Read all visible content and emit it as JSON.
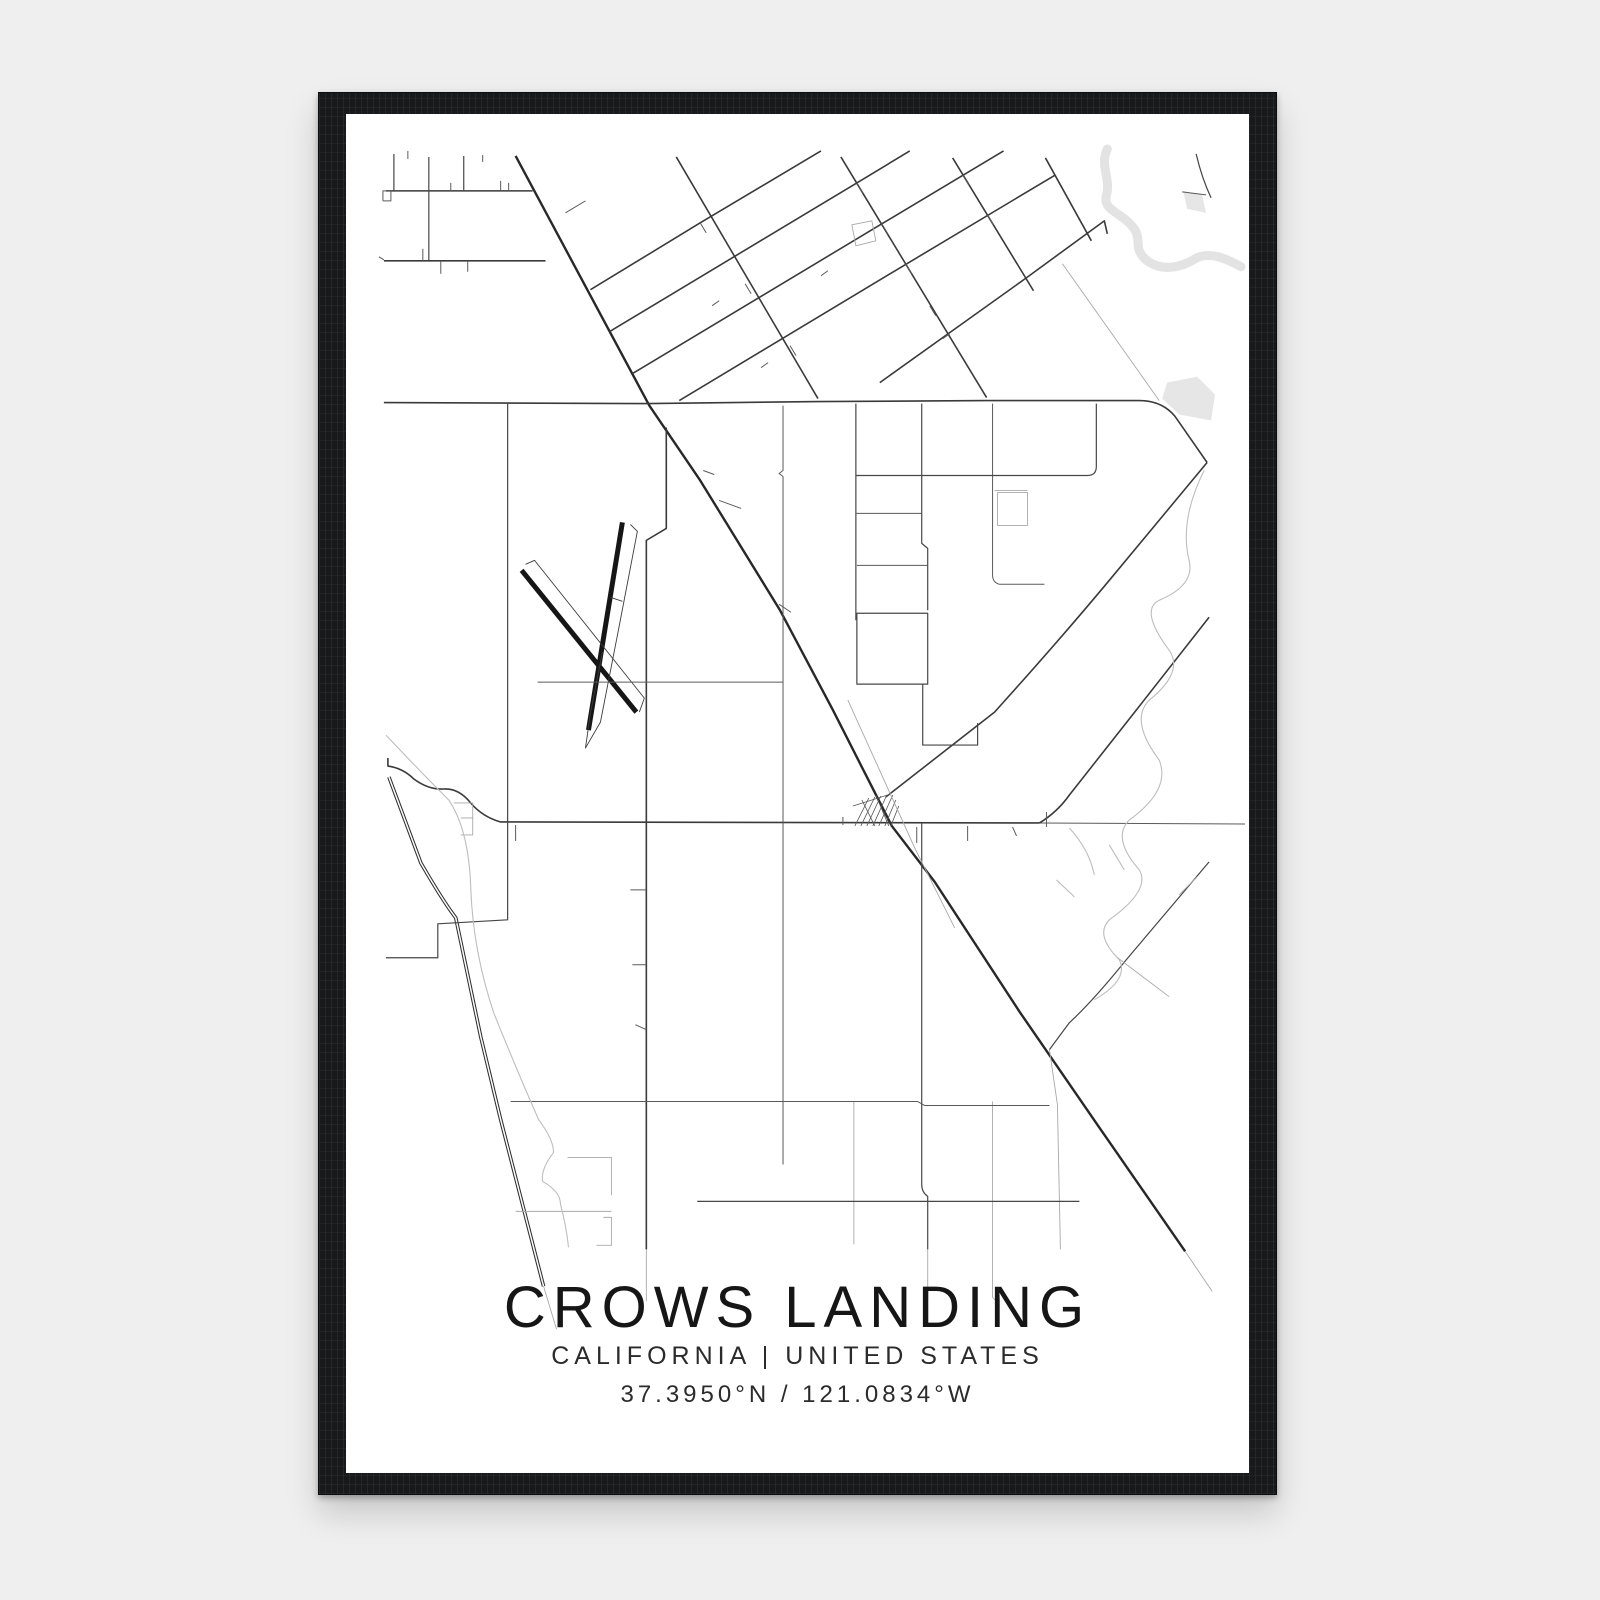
{
  "poster": {
    "title": "CROWS LANDING",
    "subtitle": "CALIFORNIA | UNITED STATES",
    "coordinates": "37.3950°N / 121.0834°W"
  },
  "theme": {
    "page-bg": "#efefef",
    "frame-color": "#17191b",
    "paper-color": "#ffffff",
    "ink": "#1e1e1e"
  },
  "map": {
    "view": "345 113 905 1361",
    "road_color": "#3a3a3a",
    "highway_color": "#282828",
    "water_color": "#e3e3e3",
    "fills": [
      {
        "n": "river-pond",
        "pts": "1168,382 1198,376 1216,394 1212,420 1180,414 1163,398"
      },
      {
        "n": "river-pond-small",
        "pts": "1184,190 1203,194 1207,212 1188,208"
      }
    ],
    "paths": [
      {
        "n": "river",
        "c": "water",
        "d": "M1108,148 C1100,165 1112,178 1107,195 C1103,210 1124,212 1135,228 C1143,240 1133,248 1148,260 C1162,270 1180,268 1196,258 C1210,250 1228,258 1242,266"
      },
      {
        "n": "highway",
        "c": "hwy",
        "d": "M515,155 L649,405 L700,480 L780,610 L833,710 L892,826 L935,882 L1020,1012 L1100,1128 L1186,1252"
      },
      {
        "n": "highway-fade",
        "c": "faint",
        "d": "M1186,1252 L1213,1292"
      },
      {
        "n": "canal",
        "c": "canal",
        "double": true,
        "d": "M388,777 L420,863 Q442,901 455,918 L480,1037 Q490,1078 500,1120 L543,1287"
      },
      {
        "n": "canal-fade",
        "c": "faint",
        "d": "M543,1287 L556,1330"
      },
      {
        "n": "runway-1",
        "c": "runway",
        "d": "M622,522 L588,730"
      },
      {
        "n": "runway-2",
        "c": "runway",
        "d": "M521,570 L636,712"
      },
      {
        "n": "runway-taxiway",
        "c": "rthin",
        "d": "M630,524 L637,531 L618,630 L600,722 L585,748 L590,713 L602,652"
      },
      {
        "n": "runway-taxiway",
        "c": "rthin",
        "d": "M525,564 L534,560 L644,698 L639,712"
      },
      {
        "n": "runway-taxiway",
        "c": "rthin",
        "d": "M610,597 L622,601"
      },
      {
        "n": "road-main-upper",
        "c": "med",
        "d": "M383,402 L648,403 L818,401 L987,400 L1140,400 Q1163,400 1176,416 L1208,462"
      },
      {
        "n": "road-northeast-1",
        "c": "med",
        "d": "M1208,462 L1110,580 Q1060,640 995,712 L886,797"
      },
      {
        "n": "road-main-town",
        "c": "med",
        "d": "M387,758 L387,766 Q402,768 413,779 Q428,790 443,789 Q458,788 470,803 Q482,817 500,822 L1040,823"
      },
      {
        "n": "road-main-town-east",
        "c": "thin",
        "d": "M1040,823 L1246,824"
      },
      {
        "n": "road-northeast-2",
        "c": "med",
        "d": "M1040,823 Q1058,812 1070,795 L1137,710 L1210,617"
      },
      {
        "n": "road-northeast-3",
        "c": "medthin",
        "d": "M1210,862 L1127,960 Q1093,1002 1070,1023 L1050,1050"
      },
      {
        "n": "road-northeast-3-south",
        "c": "faint",
        "d": "M1050,1050 L1058,1105 L1061,1250"
      },
      {
        "n": "road-spur",
        "c": "faint",
        "d": "M1117,957 L1170,997"
      },
      {
        "n": "road-spur",
        "c": "faint",
        "d": "M1180,895 L1198,877"
      },
      {
        "n": "grid-nw-h1",
        "c": "med",
        "d": "M385,190 L532,190"
      },
      {
        "n": "grid-nw-h2",
        "c": "med",
        "d": "M383,260 L545,260"
      },
      {
        "n": "grid-nw-v1",
        "c": "medthin",
        "d": "M393,153 L393,190"
      },
      {
        "n": "grid-nw-v2",
        "c": "medthin",
        "d": "M428,156 L428,260"
      },
      {
        "n": "grid-nw-v3",
        "c": "medthin",
        "d": "M463,155 L463,190"
      },
      {
        "n": "grid-nw-stub",
        "c": "thin",
        "d": "M407,150 L407,158"
      },
      {
        "n": "grid-nw-stub",
        "c": "thin",
        "d": "M440,260 L440,273"
      },
      {
        "n": "grid-nw-stub",
        "c": "thin",
        "d": "M467,260 L467,271"
      },
      {
        "n": "grid-nw-stub",
        "c": "thin",
        "d": "M500,180 L500,190"
      },
      {
        "n": "grid-nw-stub",
        "c": "thin",
        "d": "M482,154 L482,161"
      },
      {
        "n": "grid-nw-stub",
        "c": "thin",
        "d": "M508,182 L508,190"
      },
      {
        "n": "grid-nw-stub",
        "c": "thin",
        "d": "M422,248 L422,260"
      },
      {
        "n": "grid-nw-stub",
        "c": "thin",
        "d": "M450,182 L450,190"
      },
      {
        "n": "grid-nw-stub",
        "c": "thin",
        "d": "M378,256 L383,259"
      },
      {
        "n": "grid-nw-square",
        "c": "thin",
        "d": "M382,200 L382,190 L390,190 L390,200 L382,200"
      },
      {
        "n": "highway-spur",
        "c": "thin",
        "d": "M565,212 L585,200"
      },
      {
        "n": "grid-ne-q1",
        "c": "med",
        "d": "M676,156 L818,398"
      },
      {
        "n": "grid-ne-q2",
        "c": "med",
        "d": "M841,156 L987,397"
      },
      {
        "n": "grid-ne-q3",
        "c": "med",
        "d": "M953,157 L1034,290"
      },
      {
        "n": "grid-ne-q4",
        "c": "med",
        "d": "M1046,157 L1092,240"
      },
      {
        "n": "grid-ne-p1",
        "c": "med",
        "d": "M590,289 L700,222 L821,150"
      },
      {
        "n": "grid-ne-p2",
        "c": "med",
        "d": "M609,331 L857,182 L910,150"
      },
      {
        "n": "grid-ne-p3",
        "c": "med",
        "d": "M632,373 L882,223 L1004,150"
      },
      {
        "n": "grid-ne-p4",
        "c": "med",
        "d": "M679,400 L907,263 L1056,174"
      },
      {
        "n": "grid-ne-p5",
        "c": "med",
        "d": "M880,382 L1027,277 L1105,220 L1108,233"
      },
      {
        "n": "grid-ne-faint-street",
        "c": "faint",
        "d": "M1063,263 L1160,400"
      },
      {
        "n": "grid-ne-building",
        "c": "faint",
        "d": "M852,224 L872,220 L876,240 L856,245 Z"
      },
      {
        "n": "grid-ne-tick",
        "c": "thin",
        "d": "M700,222 L706,232"
      },
      {
        "n": "grid-ne-tick",
        "c": "thin",
        "d": "M745,283 L751,293"
      },
      {
        "n": "grid-ne-tick",
        "c": "thin",
        "d": "M790,345 L796,355"
      },
      {
        "n": "grid-ne-tick",
        "c": "thin",
        "d": "M857,182 L863,192"
      },
      {
        "n": "grid-ne-tick",
        "c": "thin",
        "d": "M882,223 L888,233"
      },
      {
        "n": "grid-ne-tick",
        "c": "thin",
        "d": "M906,263 L912,273"
      },
      {
        "n": "grid-ne-tick",
        "c": "thin",
        "d": "M930,305 L936,315"
      },
      {
        "n": "grid-ne-tick",
        "c": "thin",
        "d": "M963,174 L969,184"
      },
      {
        "n": "grid-ne-tick",
        "c": "thin",
        "d": "M988,214 L994,224"
      },
      {
        "n": "grid-ne-tick",
        "c": "thin",
        "d": "M719,300 L712,305"
      },
      {
        "n": "grid-ne-tick",
        "c": "thin",
        "d": "M768,362 L761,367"
      },
      {
        "n": "grid-ne-tick",
        "c": "thin",
        "d": "M828,270 L821,275"
      },
      {
        "n": "grid-ne-tick",
        "c": "thin",
        "d": "M950,333 L943,338"
      },
      {
        "n": "highway-spur",
        "c": "thin",
        "d": "M703,470 L714,474"
      },
      {
        "n": "highway-spur",
        "c": "thin",
        "d": "M719,500 L741,508"
      },
      {
        "n": "highway-spur",
        "c": "thin",
        "d": "M779,604 L791,612"
      },
      {
        "n": "road-vertical-center",
        "c": "med",
        "d": "M666,427 L666,528 L646,540 L646,1250"
      },
      {
        "n": "road-vertical-center-fade",
        "c": "faint",
        "d": "M646,1250 L646,1302"
      },
      {
        "n": "road-tick",
        "c": "thin",
        "d": "M630,890 L646,890"
      },
      {
        "n": "road-tick",
        "c": "thin",
        "d": "M632,965 L646,965"
      },
      {
        "n": "road-tick",
        "c": "thin",
        "d": "M635,1025 L646,1030"
      },
      {
        "n": "road-vertical-west",
        "c": "medthin",
        "d": "M507,403 L507,920 L437,924 L437,958 L385,958"
      },
      {
        "n": "road-horizontal-airfield",
        "c": "thin",
        "d": "M537,682 L783,682"
      },
      {
        "n": "road-vertical-783",
        "c": "thin",
        "d": "M783,405 L783,470 L779,473 L783,476 L783,1165"
      },
      {
        "n": "road-vertical-856",
        "c": "medthin",
        "d": "M856,403 L856,620"
      },
      {
        "n": "road-tick",
        "c": "thin",
        "d": "M856,513 L922,513"
      },
      {
        "n": "road-h-565",
        "c": "thin",
        "d": "M857,565 L928,565"
      },
      {
        "n": "road-block",
        "c": "medthin",
        "d": "M857,613 L928,613 L928,684 L857,684 Z"
      },
      {
        "n": "road-vertical-922",
        "c": "medthin",
        "d": "M922,403 L922,543 L928,548 L928,610"
      },
      {
        "n": "road-block",
        "c": "medthin",
        "d": "M923,684 L923,745 L978,745 L978,723"
      },
      {
        "n": "road-vertical-922-south",
        "c": "medthin",
        "d": "M922,823 L922,1185 Q922,1193 928,1197 L928,1250"
      },
      {
        "n": "road-vertical-922-fade",
        "c": "faint",
        "d": "M928,1250 L928,1300"
      },
      {
        "n": "road-vertical-993",
        "c": "thin",
        "d": "M993,403 L993,575 Q993,582 1000,584 L1045,584"
      },
      {
        "n": "road-corner-block",
        "c": "medthin",
        "d": "M856,475 L1088,475 Q1097,475 1097,466 L1097,403"
      },
      {
        "n": "road-h-490",
        "c": "faint",
        "d": "M995,490 L1028,490"
      },
      {
        "n": "field-square",
        "c": "faint",
        "d": "M998,492 L1028,492 L1028,525 L998,525 Z"
      },
      {
        "n": "road-vertical-854-south",
        "c": "faint",
        "d": "M854,1102 L854,1245"
      },
      {
        "n": "road-vertical-993-south",
        "c": "faint",
        "d": "M993,1102 L993,1298 L1000,1306"
      },
      {
        "n": "road-horizontal-1102",
        "c": "thin",
        "d": "M510,1102 L918,1102 L925,1106 L1050,1106"
      },
      {
        "n": "road-horizontal-1202",
        "c": "medthin",
        "d": "M697,1202 L1080,1202"
      },
      {
        "n": "grid-sw-faint",
        "c": "faint",
        "d": "M567,1158 L611,1158 L611,1196"
      },
      {
        "n": "grid-sw-faint",
        "c": "faint",
        "d": "M515,1212 L611,1212"
      },
      {
        "n": "grid-sw-faint",
        "c": "faint",
        "d": "M603,1218 L611,1218 L611,1246 L596,1246"
      },
      {
        "n": "road-step",
        "c": "faint",
        "d": "M453,803 L472,803 L472,835 L460,835"
      },
      {
        "n": "road-step-tick",
        "c": "faint",
        "d": "M460,818 L472,818"
      },
      {
        "n": "road-stub",
        "c": "thin",
        "d": "M515,825 L515,841"
      },
      {
        "n": "town-grid-edge",
        "c": "hatch",
        "d": "M853,806 L891,794"
      },
      {
        "n": "town-grid-street",
        "c": "hatch",
        "d": "M855,826 L869,798"
      },
      {
        "n": "town-grid-street",
        "c": "hatch",
        "d": "M861,826 L875,797"
      },
      {
        "n": "town-grid-street",
        "c": "hatch",
        "d": "M867,826 L881,796"
      },
      {
        "n": "town-grid-street",
        "c": "hatch",
        "d": "M873,826 L887,795"
      },
      {
        "n": "town-grid-street",
        "c": "hatch",
        "d": "M879,826 L893,795"
      },
      {
        "n": "town-grid-street",
        "c": "hatch",
        "d": "M885,826 L896,800"
      },
      {
        "n": "town-grid-street",
        "c": "hatch",
        "d": "M891,826 L899,806"
      },
      {
        "n": "town-grid-cross",
        "c": "hatch",
        "d": "M862,800 L875,826"
      },
      {
        "n": "town-grid-cross",
        "c": "hatch",
        "d": "M876,795 L889,826"
      },
      {
        "n": "town-stub",
        "c": "thin",
        "d": "M917,827 L917,843"
      },
      {
        "n": "town-stub",
        "c": "thin",
        "d": "M968,826 L968,841"
      },
      {
        "n": "town-stub",
        "c": "thin",
        "d": "M1013,827 L1017,836"
      },
      {
        "n": "town-stub",
        "c": "thin",
        "d": "M1047,812 L1047,827"
      },
      {
        "n": "town-stub",
        "c": "thin",
        "d": "M843,817 L843,825"
      },
      {
        "n": "railroad-parallel",
        "c": "faint",
        "d": "M848,700 L915,848 L955,928"
      },
      {
        "n": "creek-west",
        "c": "creek",
        "d": "M385,735 Q418,770 448,800 Q468,830 470,887 Q472,950 493,1013 Q515,1068 538,1120 Q553,1140 553,1153 Q540,1170 542,1182 Q560,1192 560,1205 Q566,1228 568,1248"
      },
      {
        "n": "creek-east",
        "c": "creek",
        "d": "M1205,470 Q1180,520 1190,560 Q1196,585 1160,600 Q1140,610 1170,650 Q1185,672 1150,700 Q1130,720 1160,760 Q1172,790 1130,820 Q1112,838 1140,870 Q1152,890 1110,920 Q1095,935 1120,960 Q1130,980 1095,1000"
      },
      {
        "n": "creek-twig",
        "c": "creek",
        "d": "M1070,828 Q1090,850 1095,875"
      },
      {
        "n": "creek-twig",
        "c": "creek",
        "d": "M1110,845 L1125,870"
      },
      {
        "n": "creek-twig",
        "c": "creek",
        "d": "M1057,880 L1075,897"
      },
      {
        "n": "road-hook-ne",
        "c": "medthin",
        "d": "M1197,153 Q1203,178 1212,197"
      },
      {
        "n": "road-hook-branch",
        "c": "thin",
        "d": "M1183,191 L1207,194"
      }
    ]
  }
}
